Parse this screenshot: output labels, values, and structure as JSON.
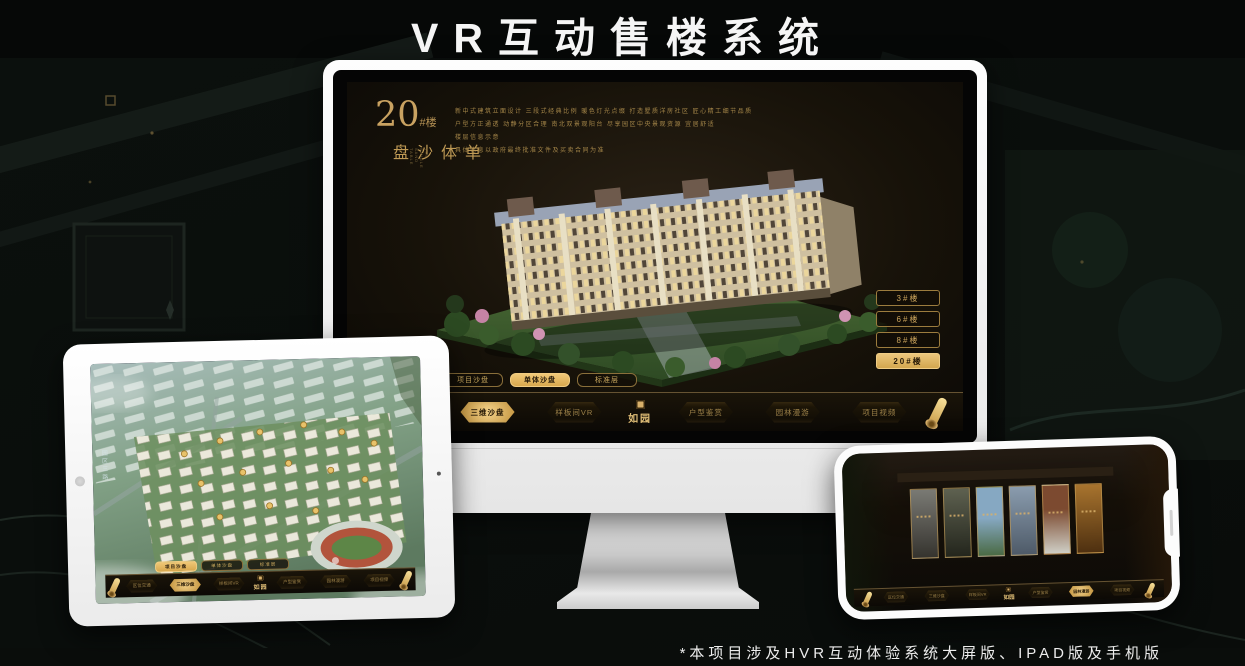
{
  "title": "VR互动售楼系统",
  "footnote": "*本项目涉及HVR互动体验系统大屏版、IPAD版及手机版",
  "colors": {
    "gold": "#d4af6a",
    "gold_bright": "#f0c878",
    "app_bg": "#15100a",
    "frame_white": "#f5f5f5"
  },
  "nav": {
    "logo": "如园",
    "items": [
      "区位交通",
      "三维沙盘",
      "样板间VR",
      "户型鉴赏",
      "园林漫游",
      "项目视频"
    ]
  },
  "monitor": {
    "headline_number": "20",
    "headline_suffix": "#楼",
    "headline_vertical": "单体沙盘",
    "headline_en": "THE SINGLE SAND TABLE",
    "fine_print_lines": [
      "新中式建筑立面设计 三段式经典比例 暖色灯光点缀 打造墅质洋房社区 匠心精工细节品质",
      "户型方正通透 动静分区合理 南北双景观阳台 尽享园区中央景观资源 宜居舒适",
      "楼层信息示意",
      "具体信息以政府最终批准文件及买卖合同为准"
    ],
    "floor_buttons": [
      "3#楼",
      "6#楼",
      "8#楼",
      "20#楼"
    ],
    "active_floor": "20#楼",
    "view_tabs": [
      "项目沙盘",
      "单体沙盘",
      "标准层"
    ],
    "active_view_tab": "单体沙盘",
    "nav_active_item": "三维沙盘"
  },
  "tablet": {
    "view_tabs": [
      "项目沙盘",
      "单体沙盘",
      "标准层"
    ],
    "active_view_tab": "项目沙盘",
    "street_label": "园区三路",
    "nav_active_item": "三维沙盘"
  },
  "phone": {
    "nav_active_item": "园林漫游"
  }
}
